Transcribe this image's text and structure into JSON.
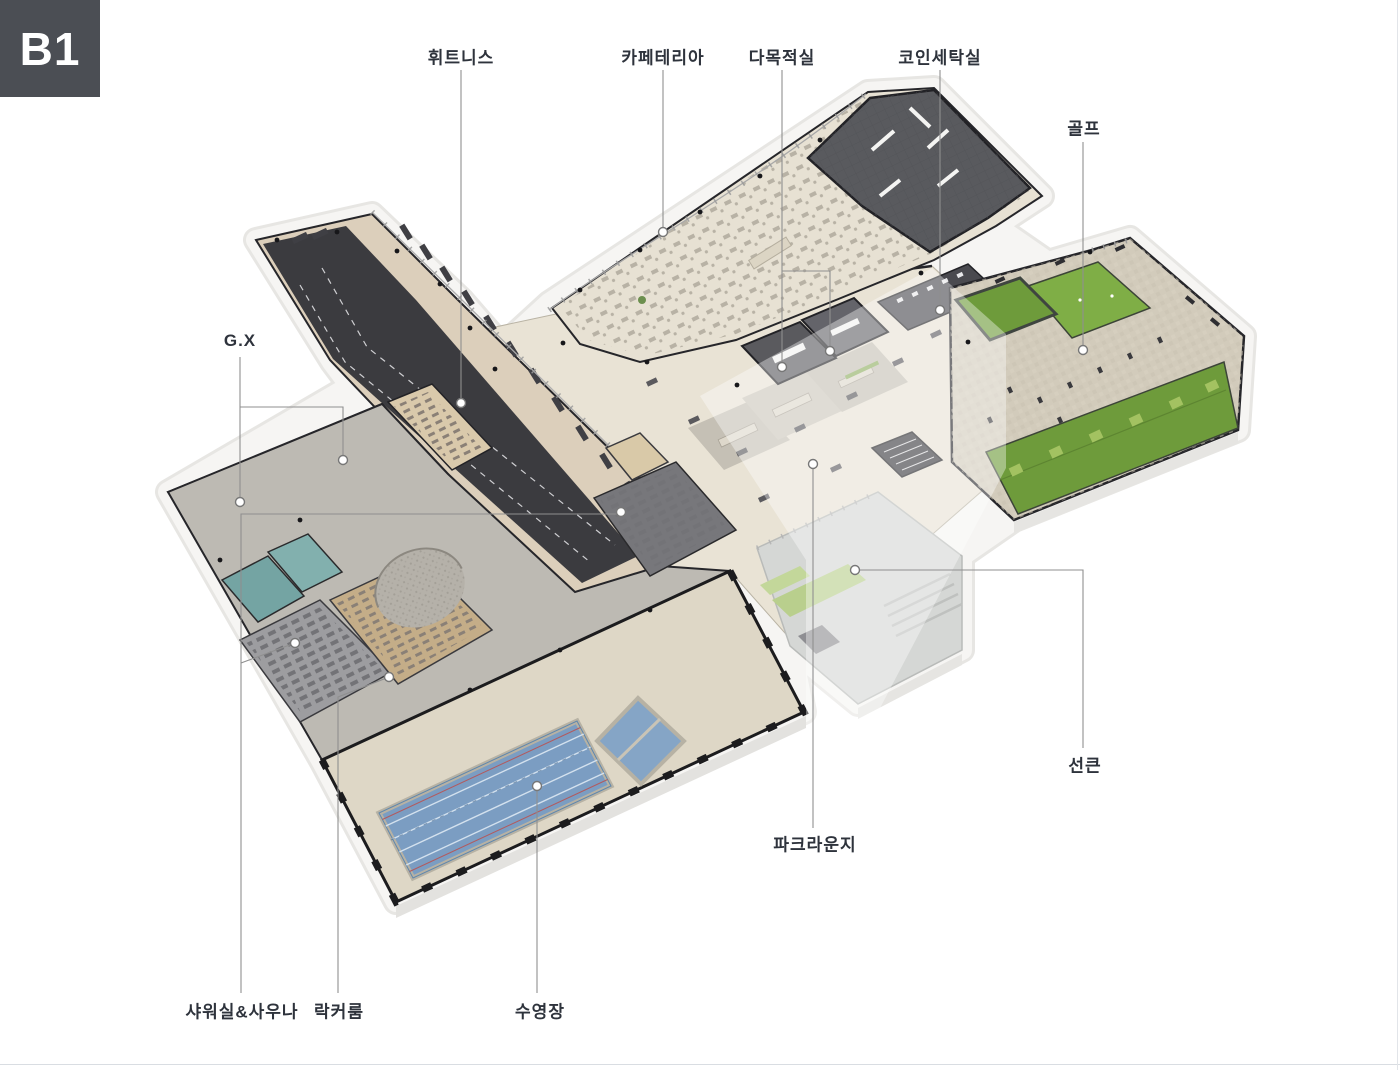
{
  "badge": {
    "text": "B1",
    "bg": "#4b4e54",
    "fg": "#ffffff"
  },
  "labels": [
    {
      "id": "fitness",
      "text": "휘트니스"
    },
    {
      "id": "cafeteria",
      "text": "카페테리아"
    },
    {
      "id": "multipurpose",
      "text": "다목적실"
    },
    {
      "id": "coin-laundry",
      "text": "코인세탁실"
    },
    {
      "id": "golf",
      "text": "골프"
    },
    {
      "id": "gx",
      "text": "G.X"
    },
    {
      "id": "sunken",
      "text": "선큰"
    },
    {
      "id": "park-lounge",
      "text": "파크라운지"
    },
    {
      "id": "shower-sauna",
      "text": "샤워실&사우나"
    },
    {
      "id": "locker-room",
      "text": "락커룸"
    },
    {
      "id": "pool",
      "text": "수영장"
    }
  ],
  "colors": {
    "label_text": "#2e333c",
    "leader_line": "#8f8f8f",
    "platform": "#f4f3f1",
    "floor_beige": "#e7e1d3",
    "wood": "#dccfbb",
    "track_dark": "#3b3b3f",
    "laundry_dark": "#595a5e",
    "pool_water": "#7b9dc2",
    "turf_green": "#6e9b3b",
    "putting_green": "#7fae46",
    "teal_bath": "#74a4a3",
    "sunken_deck": "#d5d7d5",
    "wall_dark": "#26262a"
  }
}
